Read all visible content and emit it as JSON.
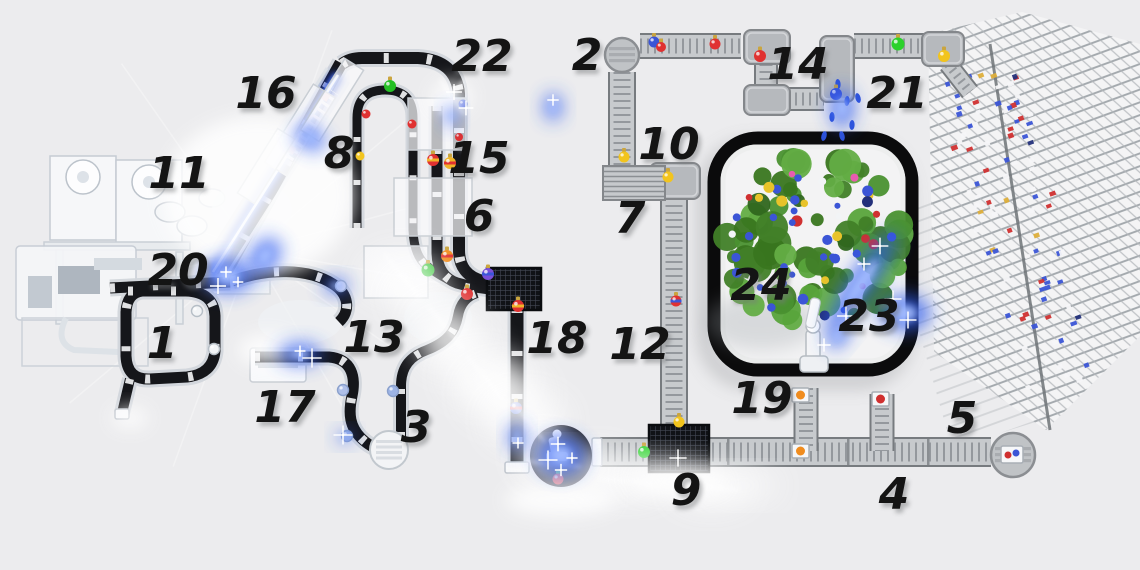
{
  "meta": {
    "background": "#ececee",
    "description_numbers_visible": "1-24"
  },
  "stations": [
    {
      "n": "1",
      "x": 162,
      "y": 343
    },
    {
      "n": "2",
      "x": 587,
      "y": 55
    },
    {
      "n": "3",
      "x": 416,
      "y": 427
    },
    {
      "n": "4",
      "x": 894,
      "y": 494
    },
    {
      "n": "5",
      "x": 962,
      "y": 418
    },
    {
      "n": "6",
      "x": 479,
      "y": 216
    },
    {
      "n": "7",
      "x": 630,
      "y": 218
    },
    {
      "n": "8",
      "x": 339,
      "y": 153
    },
    {
      "n": "9",
      "x": 686,
      "y": 490
    },
    {
      "n": "10",
      "x": 669,
      "y": 144
    },
    {
      "n": "11",
      "x": 179,
      "y": 173
    },
    {
      "n": "12",
      "x": 640,
      "y": 344
    },
    {
      "n": "13",
      "x": 374,
      "y": 337
    },
    {
      "n": "14",
      "x": 798,
      "y": 64
    },
    {
      "n": "15",
      "x": 479,
      "y": 158
    },
    {
      "n": "16",
      "x": 266,
      "y": 93
    },
    {
      "n": "17",
      "x": 285,
      "y": 407
    },
    {
      "n": "18",
      "x": 557,
      "y": 338
    },
    {
      "n": "19",
      "x": 762,
      "y": 398
    },
    {
      "n": "20",
      "x": 178,
      "y": 270
    },
    {
      "n": "21",
      "x": 897,
      "y": 93
    },
    {
      "n": "22",
      "x": 482,
      "y": 56
    },
    {
      "n": "23",
      "x": 869,
      "y": 316
    },
    {
      "n": "24",
      "x": 761,
      "y": 285
    }
  ],
  "label_style": {
    "size": 44,
    "color": "#141414",
    "shadow": "#77797c"
  },
  "belts_dark": [
    {
      "d": "M 342,64 Q 350,58 362,58 L 418,58 Q 456,60 459,94 L 459,128",
      "w": 12
    },
    {
      "d": "M 459,128 L 459,250 Q 459,275 483,281 L 504,286",
      "w": 12
    },
    {
      "d": "M 437,106 L 437,252 Q 437,276 457,283 L 472,287",
      "w": 11
    },
    {
      "d": "M 357,228 L 357,118 Q 357,90 385,90 Q 413,90 413,118 L 413,230 Q 414,256 427,266",
      "w": 9
    },
    {
      "d": "M 427,266 Q 446,281 468,287 L 497,291",
      "w": 9
    },
    {
      "d": "M 517,308 L 517,464",
      "w": 13
    },
    {
      "d": "M 232,281 C 268,268 308,268 333,284 C 349,294 351,311 339,322",
      "w": 11
    },
    {
      "d": "M 255,357 L 329,357 C 352,359 356,377 352,396 C 348,414 350,427 361,438 Q 371,448 384,451",
      "w": 11
    },
    {
      "d": "M 401,437 L 401,386 C 401,366 411,356 427,350 C 447,342 455,332 458,316 Q 461,298 477,293",
      "w": 10
    },
    {
      "d": "M 128,291 L 186,291 Q 214,292 215,316 L 215,351 Q 213,374 187,377 L 150,379 Q 127,380 126,356 L 126,312 Q 127,293 142,291",
      "w": 11
    },
    {
      "d": "M 130,379 L 122,413",
      "w": 10
    },
    {
      "d": "M 110,288 L 230,282",
      "w": 11
    },
    {
      "d": "M 223,277 L 341,63",
      "w": 13
    }
  ],
  "belts_gray": [
    {
      "d": "M 622,72 L 622,168",
      "w": 24
    },
    {
      "d": "M 640,46 L 741,46",
      "w": 22
    },
    {
      "d": "M 766,64 L 766,88",
      "w": 20
    },
    {
      "d": "M 788,99 L 824,99",
      "w": 20
    },
    {
      "d": "M 854,46 L 924,46",
      "w": 22
    },
    {
      "d": "M 674,198 L 674,426",
      "w": 24
    },
    {
      "d": "M 600,452 L 991,452",
      "w": 26
    },
    {
      "d": "M 806,388 L 806,451",
      "w": 21
    },
    {
      "d": "M 882,394 L 882,451",
      "w": 21
    },
    {
      "d": "M 948,64 L 970,92",
      "w": 16
    }
  ],
  "turn_modules": [
    {
      "x": 744,
      "y": 30,
      "w": 46,
      "h": 34
    },
    {
      "x": 744,
      "y": 85,
      "w": 46,
      "h": 30
    },
    {
      "x": 820,
      "y": 36,
      "w": 34,
      "h": 66
    },
    {
      "x": 922,
      "y": 32,
      "w": 42,
      "h": 34
    },
    {
      "x": 650,
      "y": 163,
      "w": 50,
      "h": 36
    }
  ],
  "buffer": {
    "x": 603,
    "y": 166,
    "w": 62,
    "h": 34
  },
  "turntables_gray": [
    {
      "cx": 622,
      "cy": 55,
      "r": 17
    },
    {
      "cx": 1013,
      "cy": 455,
      "r": 22
    }
  ],
  "turntable_white": {
    "cx": 389,
    "cy": 450,
    "r": 19
  },
  "platforms": [
    {
      "x": 487,
      "y": 268,
      "w": 54,
      "h": 42
    },
    {
      "x": 649,
      "y": 425,
      "w": 60,
      "h": 47
    }
  ],
  "caps": [
    {
      "x": 505,
      "y": 462,
      "w": 24,
      "h": 11
    },
    {
      "x": 592,
      "y": 438,
      "w": 10,
      "h": 28
    },
    {
      "x": 115,
      "y": 409,
      "w": 14,
      "h": 10
    }
  ],
  "dividers": [
    {
      "x": 728,
      "y": 452
    },
    {
      "x": 848,
      "y": 452
    },
    {
      "x": 928,
      "y": 452
    }
  ],
  "black_station": {
    "cx": 561,
    "cy": 456,
    "r": 31
  },
  "boxes": [
    {
      "x": 792,
      "y": 388,
      "c": "#f08c1e"
    },
    {
      "x": 792,
      "y": 444,
      "c": "#f08c1e"
    },
    {
      "x": 872,
      "y": 392,
      "c": "#d03030"
    }
  ],
  "package": {
    "x": 1001,
    "y": 446,
    "w": 22,
    "h": 17,
    "dot1": "#d03030",
    "dot2": "#3b55d6"
  },
  "ornaments": [
    {
      "x": 390,
      "y": 86,
      "r": 6,
      "c": "#25c025",
      "cap": true
    },
    {
      "x": 366,
      "y": 114,
      "r": 4.5,
      "c": "#e03131"
    },
    {
      "x": 412,
      "y": 124,
      "r": 4.5,
      "c": "#e03131"
    },
    {
      "x": 360,
      "y": 156,
      "r": 4.5,
      "c": "#f2c41d"
    },
    {
      "x": 459,
      "y": 137,
      "r": 4,
      "c": "#e03131"
    },
    {
      "x": 463,
      "y": 104,
      "r": 4.5,
      "c": "#3b55d6"
    },
    {
      "x": 433,
      "y": 160,
      "r": 6,
      "c": "#e03131",
      "band": "#f0b429",
      "cap": true
    },
    {
      "x": 450,
      "y": 163,
      "r": 6,
      "c": "#f0b429",
      "band": "#e03131",
      "cap": true
    },
    {
      "x": 428,
      "y": 270,
      "r": 6.5,
      "c": "#25c025",
      "cap": true
    },
    {
      "x": 447,
      "y": 256,
      "r": 6,
      "c": "#f08c1e",
      "band": "#e03131",
      "cap": true
    },
    {
      "x": 488,
      "y": 274,
      "r": 6,
      "c": "#7a4fd8",
      "band": "#3b55d6",
      "cap": true
    },
    {
      "x": 467,
      "y": 294,
      "r": 6,
      "c": "#e03131",
      "cap": true
    },
    {
      "x": 518,
      "y": 306,
      "r": 6,
      "c": "#e03131",
      "band": "#f0b429",
      "cap": true
    },
    {
      "x": 516,
      "y": 408,
      "r": 6,
      "c": "#3b55d6",
      "band": "#e03131",
      "cap": true
    },
    {
      "x": 558,
      "y": 479,
      "r": 5.5,
      "c": "#e03131",
      "capc": "#2bd12b"
    },
    {
      "x": 197,
      "y": 311,
      "r": 5.5,
      "c": "#f2f4f6",
      "st": "#b6bec6"
    },
    {
      "x": 214,
      "y": 349,
      "r": 5.5,
      "c": "#f2f4f6",
      "st": "#b6bec6"
    },
    {
      "x": 341,
      "y": 286,
      "r": 5.5,
      "c": "#f2f4f6",
      "st": "#b6bec6"
    },
    {
      "x": 343,
      "y": 390,
      "r": 5.5,
      "c": "#aebfe8",
      "st": "#8aa0cc"
    },
    {
      "x": 347,
      "y": 436,
      "r": 5.5,
      "c": "#9db4e6",
      "st": "#8aa0cc"
    },
    {
      "x": 393,
      "y": 391,
      "r": 5.5,
      "c": "#9db4e6",
      "st": "#8aa0cc"
    },
    {
      "x": 654,
      "y": 42,
      "r": 5.5,
      "c": "#3b55d6",
      "cap": true
    },
    {
      "x": 661,
      "y": 47,
      "r": 5,
      "c": "#e03131",
      "cap": true
    },
    {
      "x": 715,
      "y": 44,
      "r": 5.5,
      "c": "#e03131",
      "cap": true
    },
    {
      "x": 760,
      "y": 56,
      "r": 6,
      "c": "#e03131",
      "cap": true
    },
    {
      "x": 836,
      "y": 94,
      "r": 6,
      "c": "#3b55d6",
      "cap": true
    },
    {
      "x": 898,
      "y": 44,
      "r": 6.5,
      "c": "#2bd12b",
      "cap": true
    },
    {
      "x": 944,
      "y": 56,
      "r": 6,
      "c": "#f2c41d",
      "cap": true
    },
    {
      "x": 624,
      "y": 157,
      "r": 5.5,
      "c": "#f2c41d",
      "cap": true
    },
    {
      "x": 668,
      "y": 177,
      "r": 5.5,
      "c": "#f2c41d",
      "cap": true
    },
    {
      "x": 676,
      "y": 301,
      "r": 5.5,
      "c": "#e03131",
      "band": "#3b55d6",
      "cap": true
    },
    {
      "x": 679,
      "y": 422,
      "r": 5.5,
      "c": "#f2c41d",
      "cap": true
    },
    {
      "x": 644,
      "y": 452,
      "r": 6,
      "c": "#2bd12b",
      "cap": true
    }
  ],
  "machines": [
    {
      "t": "rect",
      "x": 50,
      "y": 156,
      "w": 66,
      "h": 84,
      "f": "#f6f7f9",
      "s": "#c5cbd3"
    },
    {
      "t": "rect",
      "x": 116,
      "y": 160,
      "w": 66,
      "h": 86,
      "f": "#f6f7f9",
      "s": "#c5cbd3"
    },
    {
      "t": "circle",
      "cx": 83,
      "cy": 177,
      "r": 17,
      "f": "#fdfdfe",
      "s": "#bcc3cb"
    },
    {
      "t": "circle",
      "cx": 83,
      "cy": 177,
      "r": 6,
      "f": "#dde2e8"
    },
    {
      "t": "circle",
      "cx": 149,
      "cy": 182,
      "r": 17,
      "f": "#fdfdfe",
      "s": "#bcc3cb"
    },
    {
      "t": "circle",
      "cx": 149,
      "cy": 182,
      "r": 6,
      "f": "#dde2e8"
    },
    {
      "t": "rect",
      "x": 44,
      "y": 242,
      "w": 146,
      "h": 8,
      "f": "#e8ebee",
      "s": "#c9cfd6"
    },
    {
      "t": "rect",
      "x": 56,
      "y": 250,
      "w": 7,
      "h": 74,
      "f": "#e8ebee",
      "s": "#c9cfd6"
    },
    {
      "t": "rect",
      "x": 176,
      "y": 252,
      "w": 7,
      "h": 72,
      "f": "#e8ebee",
      "s": "#c9cfd6"
    },
    {
      "t": "ellipse",
      "cx": 170,
      "cy": 212,
      "rx": 15,
      "ry": 10,
      "f": "#f3f5f7",
      "s": "#c2c8d0"
    },
    {
      "t": "ellipse",
      "cx": 192,
      "cy": 226,
      "rx": 15,
      "ry": 10,
      "f": "#f3f5f7",
      "s": "#c2c8d0"
    },
    {
      "t": "ellipse",
      "cx": 212,
      "cy": 198,
      "rx": 13,
      "ry": 9,
      "f": "#f3f5f7",
      "s": "#c2c8d0"
    },
    {
      "t": "rect",
      "x": 16,
      "y": 246,
      "w": 120,
      "h": 74,
      "rx": 4,
      "f": "#f5f6f8",
      "s": "#c5cbd3",
      "o": 0.92
    },
    {
      "t": "rect",
      "x": 58,
      "y": 266,
      "w": 42,
      "h": 28,
      "f": "#aeb6bf"
    },
    {
      "t": "rect",
      "x": 28,
      "y": 276,
      "w": 24,
      "h": 32,
      "f": "#c2c9d1"
    },
    {
      "t": "rect",
      "x": 94,
      "y": 258,
      "w": 48,
      "h": 12,
      "f": "#d4dae0"
    },
    {
      "t": "rect",
      "x": 22,
      "y": 318,
      "w": 126,
      "h": 48,
      "f": "none",
      "s": "#ccd2d8"
    },
    {
      "t": "path",
      "d": "M 66,318 Q 54,342 74,350 L 118,352",
      "s": "#dde2e7",
      "sw": 6
    },
    {
      "t": "ellipse",
      "cx": 252,
      "cy": 210,
      "rx": 40,
      "ry": 30,
      "f": "#f0f2f5",
      "o": 0.7
    },
    {
      "t": "ellipse",
      "cx": 300,
      "cy": 322,
      "rx": 42,
      "ry": 22,
      "f": "#eff1f4",
      "o": 0.8
    },
    {
      "t": "ellipse",
      "cx": 438,
      "cy": 318,
      "rx": 34,
      "ry": 26,
      "f": "#eef0f3",
      "o": 0.8
    },
    {
      "t": "rect",
      "x": 200,
      "y": 258,
      "w": 70,
      "h": 36,
      "f": "#f2f4f6",
      "s": "#cfd5da",
      "o": 0.8
    },
    {
      "t": "rect",
      "x": 250,
      "y": 348,
      "w": 56,
      "h": 34,
      "rx": 3,
      "f": "#f8f9fb",
      "s": "#c9ced4"
    },
    {
      "t": "rect",
      "x": 258,
      "y": 356,
      "w": 40,
      "h": 4,
      "f": "#d7dbe0"
    },
    {
      "t": "rect",
      "x": 258,
      "y": 364,
      "w": 40,
      "h": 4,
      "f": "#d7dbe0"
    }
  ],
  "gantries": [
    {
      "x": 300,
      "y": 130,
      "w": 26,
      "h": 92,
      "rot": 32
    },
    {
      "x": 332,
      "y": 100,
      "w": 22,
      "h": 84,
      "rot": 32
    },
    {
      "x": 266,
      "y": 166,
      "w": 20,
      "h": 76,
      "rot": 32
    },
    {
      "x": 437,
      "y": 124,
      "w": 58,
      "h": 52,
      "rot": 0
    },
    {
      "x": 433,
      "y": 207,
      "w": 78,
      "h": 58,
      "rot": 0
    },
    {
      "x": 396,
      "y": 272,
      "w": 64,
      "h": 52,
      "rot": 0
    }
  ],
  "rack": {
    "main": [
      [
        928,
        34
      ],
      [
        1022,
        12
      ],
      [
        1140,
        44
      ],
      [
        1140,
        336
      ],
      [
        1046,
        430
      ],
      [
        934,
        352
      ]
    ],
    "ghost": [
      [
        886,
        215
      ],
      [
        1000,
        178
      ],
      [
        1058,
        415
      ],
      [
        952,
        448
      ]
    ],
    "pole": [
      990,
      44,
      1050,
      430
    ],
    "items": {
      "count": 95,
      "a": [
        975,
        70
      ],
      "b": [
        1055,
        395
      ],
      "spread": 42,
      "colors": [
        [
          "#3b55d6",
          0.38
        ],
        [
          "#d03030",
          0.22
        ],
        [
          "#f5f6f8",
          0.28
        ],
        [
          "#ddae3a",
          0.08
        ],
        [
          "#23307a",
          0.04
        ]
      ]
    }
  },
  "tree": {
    "cx": 812,
    "cy": 240,
    "r": 92,
    "leaves": 70,
    "leaf_colors": [
      "#39761f",
      "#4a9130",
      "#2f661d",
      "#58a43b",
      "#417f28",
      "#63ad45"
    ],
    "orn_count": 46,
    "orn_colors": [
      [
        "#3b55d6",
        0.45
      ],
      [
        "#d03030",
        0.16
      ],
      [
        "#e8c32a",
        0.14
      ],
      [
        "#f2f4f6",
        0.1
      ],
      [
        "#e85bb0",
        0.07
      ],
      [
        "#23307a",
        0.08
      ]
    ],
    "enclosure": {
      "x": 714,
      "y": 138,
      "w": 198,
      "h": 232,
      "rx": 44
    },
    "droplets": [
      [
        838,
        84
      ],
      [
        847,
        101
      ],
      [
        832,
        117
      ],
      [
        852,
        125
      ],
      [
        842,
        136
      ],
      [
        858,
        98
      ],
      [
        824,
        136
      ]
    ]
  },
  "beam": {
    "x1": 213,
    "y1": 272,
    "x2": 338,
    "y2": 75,
    "core": "#eef4ff",
    "mid": "#7fa4ff",
    "outer": "#1d3fd1"
  },
  "station16": {
    "x1": 288,
    "y1": 158,
    "x2": 334,
    "y2": 92,
    "marks": [
      [
        292,
        150
      ],
      [
        326,
        97
      ]
    ],
    "mark_color": "#efa3ab"
  },
  "glows_blue": [
    {
      "x": 228,
      "y": 276,
      "rx": 26,
      "ry": 17,
      "rot": 0
    },
    {
      "x": 300,
      "y": 354,
      "rx": 22,
      "ry": 11,
      "rot": 0
    },
    {
      "x": 336,
      "y": 286,
      "rx": 13,
      "ry": 8,
      "rot": 0
    },
    {
      "x": 553,
      "y": 107,
      "rx": 9,
      "ry": 14,
      "rot": 0
    },
    {
      "x": 452,
      "y": 116,
      "rx": 7,
      "ry": 10,
      "rot": 0
    },
    {
      "x": 517,
      "y": 437,
      "rx": 8,
      "ry": 14,
      "rot": 0
    },
    {
      "x": 561,
      "y": 455,
      "rx": 24,
      "ry": 20,
      "rot": 0
    },
    {
      "x": 345,
      "y": 437,
      "rx": 8,
      "ry": 6,
      "rot": 0
    },
    {
      "x": 905,
      "y": 313,
      "rx": 26,
      "ry": 18,
      "rot": 0
    },
    {
      "x": 862,
      "y": 282,
      "rx": 60,
      "ry": 13,
      "rot": -56
    },
    {
      "x": 838,
      "y": 336,
      "rx": 14,
      "ry": 9,
      "rot": -50
    },
    {
      "x": 265,
      "y": 256,
      "rx": 20,
      "ry": 14,
      "rot": -55
    },
    {
      "x": 310,
      "y": 138,
      "rx": 11,
      "ry": 16,
      "rot": -55
    },
    {
      "x": 842,
      "y": 108,
      "rx": 12,
      "ry": 20,
      "rot": 0
    }
  ],
  "glow_color": "#2f5bf0",
  "sprays": {
    "bands": [
      {
        "x1": 398,
        "y1": 272,
        "x2": 545,
        "y2": 452,
        "n": 8,
        "rx": 30,
        "ry": 20
      },
      {
        "x1": 556,
        "y1": 468,
        "x2": 748,
        "y2": 486,
        "n": 6,
        "rx": 32,
        "ry": 13
      }
    ],
    "bursts": [
      [
        452,
        97,
        20,
        16
      ],
      [
        268,
        350,
        30,
        16
      ],
      [
        228,
        276,
        18,
        12
      ],
      [
        560,
        500,
        55,
        16
      ],
      [
        680,
        482,
        46,
        13
      ],
      [
        130,
        418,
        18,
        10
      ],
      [
        258,
        196,
        95,
        80
      ]
    ]
  },
  "sparkles": [
    [
      226,
      272
    ],
    [
      238,
      282
    ],
    [
      218,
      286
    ],
    [
      558,
      444
    ],
    [
      548,
      460
    ],
    [
      572,
      458
    ],
    [
      561,
      470
    ],
    [
      864,
      264
    ],
    [
      880,
      246
    ],
    [
      893,
      299
    ],
    [
      908,
      320
    ],
    [
      846,
      316
    ],
    [
      824,
      345
    ],
    [
      300,
      351
    ],
    [
      312,
      358
    ],
    [
      518,
      443
    ],
    [
      553,
      100
    ],
    [
      454,
      92
    ],
    [
      466,
      108
    ],
    [
      678,
      458
    ],
    [
      343,
      435
    ]
  ],
  "rays": {
    "cx": 252,
    "cy": 250,
    "angles": [
      -70,
      -40,
      -15,
      10,
      35,
      60,
      110,
      140,
      165,
      200,
      235
    ],
    "len": 200
  }
}
